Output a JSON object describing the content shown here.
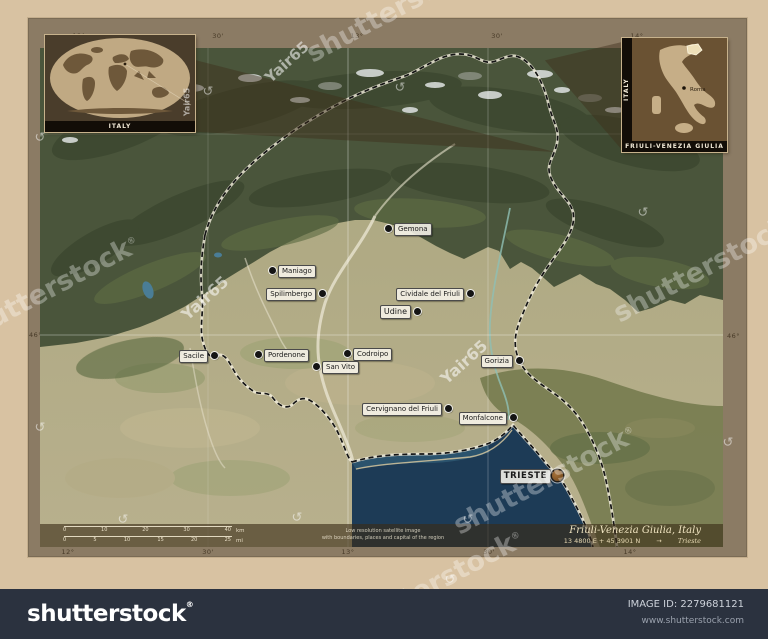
{
  "image": {
    "width": 768,
    "height": 639
  },
  "frame": {
    "top_labels": [
      {
        "text": "12°",
        "x": 79
      },
      {
        "text": "30'",
        "x": 218
      },
      {
        "text": "13°",
        "x": 357
      },
      {
        "text": "30'",
        "x": 497
      },
      {
        "text": "14°",
        "x": 637
      }
    ],
    "bottom_labels": [
      {
        "text": "12°",
        "x": 68
      },
      {
        "text": "30'",
        "x": 208
      },
      {
        "text": "13°",
        "x": 348
      },
      {
        "text": "30'",
        "x": 489
      },
      {
        "text": "14°",
        "x": 630
      }
    ],
    "left_labels": [
      {
        "text": "46°",
        "y": 331
      }
    ],
    "right_labels": [
      {
        "text": "46°",
        "y": 332
      }
    ]
  },
  "insets": {
    "world": {
      "caption": "ITALY"
    },
    "italy": {
      "caption": "FRIULI-VENEZIA GIULIA",
      "side_caption": "ITALY",
      "capital_label": "Roma"
    }
  },
  "map": {
    "places": [
      {
        "name": "Gemona",
        "x": 388,
        "y": 228,
        "side": "right",
        "kind": "town"
      },
      {
        "name": "Maniago",
        "x": 272,
        "y": 270,
        "side": "right",
        "kind": "town"
      },
      {
        "name": "Spilimbergo",
        "x": 322,
        "y": 293,
        "side": "left",
        "kind": "town"
      },
      {
        "name": "Udine",
        "x": 417,
        "y": 311,
        "side": "left",
        "kind": "city"
      },
      {
        "name": "Cividale del Friuli",
        "x": 470,
        "y": 293,
        "side": "left",
        "kind": "town"
      },
      {
        "name": "Sacile",
        "x": 214,
        "y": 355,
        "side": "left",
        "kind": "town"
      },
      {
        "name": "Pordenone",
        "x": 258,
        "y": 354,
        "side": "right",
        "kind": "town"
      },
      {
        "name": "Codroipo",
        "x": 347,
        "y": 353,
        "side": "right",
        "kind": "town"
      },
      {
        "name": "San Vito",
        "x": 316,
        "y": 366,
        "side": "right",
        "kind": "town"
      },
      {
        "name": "Gorizia",
        "x": 519,
        "y": 360,
        "side": "left",
        "kind": "town"
      },
      {
        "name": "Cervignano del Friuli",
        "x": 448,
        "y": 408,
        "side": "left",
        "kind": "town"
      },
      {
        "name": "Monfalcone",
        "x": 513,
        "y": 417,
        "side": "left",
        "kind": "town"
      },
      {
        "name": "TRIESTE",
        "x": 557,
        "y": 475,
        "side": "left",
        "kind": "capital"
      }
    ],
    "scalebar": {
      "km": {
        "ticks": [
          "0",
          "10",
          "20",
          "30",
          "40"
        ],
        "unit": "km"
      },
      "mi": {
        "ticks": [
          "0",
          "5",
          "10",
          "15",
          "20",
          "25"
        ],
        "unit": "mi"
      }
    },
    "attribution": {
      "line1": "Low resolution satellite image",
      "line2": "with boundaries, places and capital of the region"
    },
    "title_block": {
      "region": "Friuli-Venezia Giulia, Italy",
      "coordinates": "13 4800 E + 45 3901 N",
      "arrow": "→",
      "capital": "Trieste"
    }
  },
  "watermarks": {
    "brand_text": "shutterstock",
    "brand_positions": [
      {
        "x": 398,
        "y": 8,
        "rot": -28
      },
      {
        "x": 48,
        "y": 290,
        "rot": -28
      },
      {
        "x": 705,
        "y": 268,
        "rot": -28
      },
      {
        "x": 545,
        "y": 480,
        "rot": -28
      },
      {
        "x": 432,
        "y": 585,
        "rot": -28
      }
    ],
    "author_text": "Yair65",
    "author_positions": [
      {
        "x": 287,
        "y": 62,
        "rot": -42,
        "size": 15
      },
      {
        "x": 205,
        "y": 298,
        "rot": -42,
        "size": 16
      },
      {
        "x": 464,
        "y": 362,
        "rot": -42,
        "size": 16
      },
      {
        "x": 187,
        "y": 102,
        "rot": -90,
        "size": 8
      }
    ],
    "swirl_positions": [
      {
        "x": 123,
        "y": 520
      },
      {
        "x": 297,
        "y": 518
      },
      {
        "x": 468,
        "y": 520
      },
      {
        "x": 40,
        "y": 138
      },
      {
        "x": 40,
        "y": 428
      },
      {
        "x": 643,
        "y": 213
      },
      {
        "x": 728,
        "y": 443
      },
      {
        "x": 400,
        "y": 88
      },
      {
        "x": 450,
        "y": 580
      },
      {
        "x": 208,
        "y": 92
      }
    ]
  },
  "footer": {
    "logo": "shutterstock",
    "registered": "®",
    "image_id": "IMAGE ID: 2279681121",
    "website": "www.shutterstock.com"
  },
  "colors": {
    "background": "#d8c2a2",
    "matte": "#8b7b64",
    "sea": "#1d3b56",
    "mountains": "#4a553b",
    "plains": "#b2ab83",
    "footer_bar": "#2b323f",
    "inset_bg": "#4a3d2b",
    "label_cream": "#efe3c0"
  }
}
